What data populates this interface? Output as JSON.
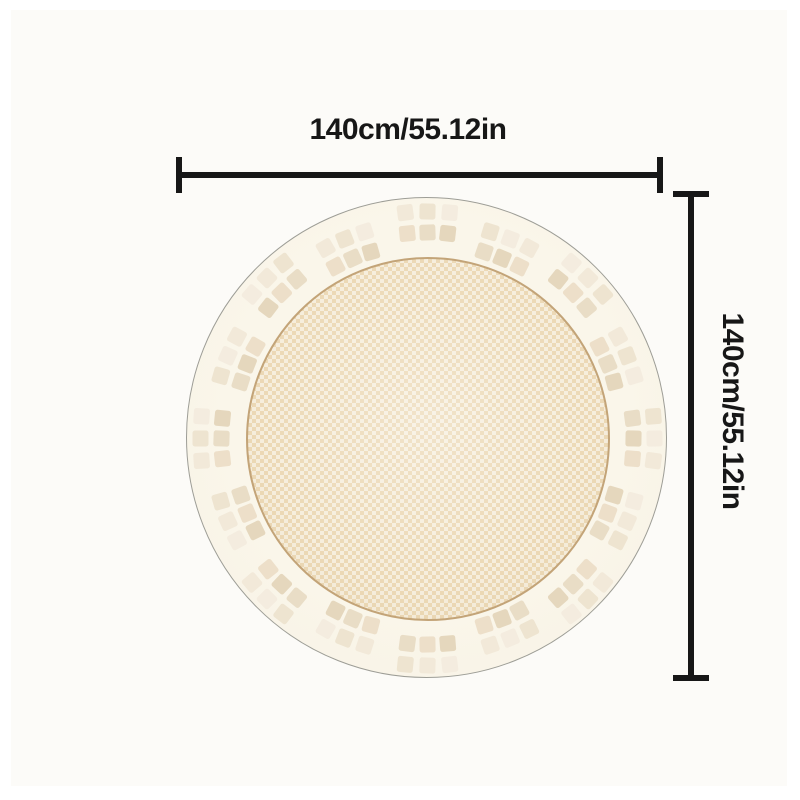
{
  "figure": {
    "type": "product-dimension-diagram",
    "width_annotation": "140cm/55.12in",
    "height_annotation": "140cm/55.12in"
  },
  "colors": {
    "annotation": "#171717",
    "background": "#fcfbf8",
    "rug_base": "#f8f3e6",
    "rug_outline": "#9d9d96",
    "rug_center_weave_a": "#ecd9b6",
    "rug_center_weave_b": "#f6eedd",
    "rug_center_border": "#c3a478",
    "square_outer_palette": [
      "#f2e9d9",
      "#eee4d0",
      "#f4ecdf"
    ],
    "square_inner_palette": [
      "#e9ddc6",
      "#e5d7bd",
      "#eddfc9"
    ]
  }
}
